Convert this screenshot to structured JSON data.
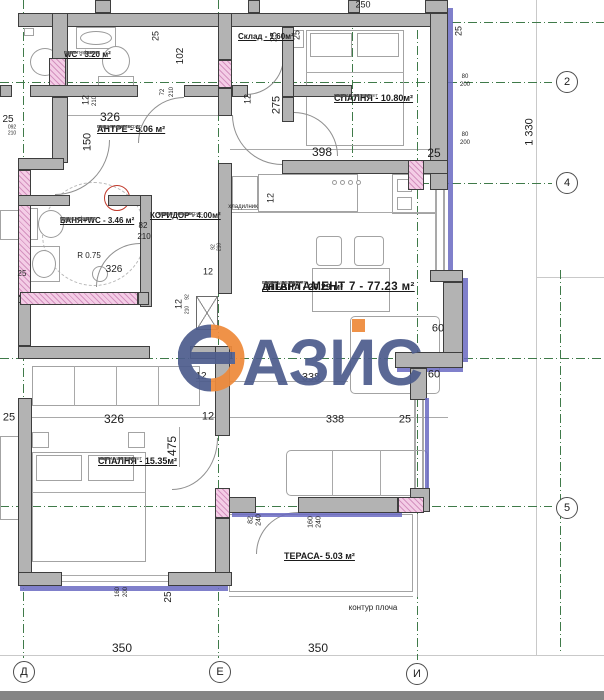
{
  "watermark": {
    "brand": "ОАЗИС",
    "rest": "АЗИС",
    "blue": "#4e5d8d",
    "orange": "#ee8a3b"
  },
  "apartment_title": "АПАРТАМЕНТ 7 - 77.23 м²",
  "rooms": {
    "wc": {
      "name": "WC - 3.20 м²",
      "f1": "под - теракот",
      "f2": "стени - фаянс",
      "f3": "таван - латекс"
    },
    "sklad": {
      "name": "Склад - 1.60м²"
    },
    "antre": {
      "name": "АНТРЕ - 5.06 м²",
      "f1": "под - гранитогрес",
      "f2": "стени - латекс",
      "f3": "таван - латекс"
    },
    "banya": {
      "name": "БАНЯ+WC - 3.46 м²",
      "f1": "под - теракот",
      "f2": "стени - фаянс",
      "f3": "таван - латекс"
    },
    "koridor": {
      "name": "КОРИДОР - 4.00м²",
      "f1": "под - гранитогрес",
      "f2": "стени - латекс",
      "f3": "таван - латекс"
    },
    "spalnya1": {
      "name": "СПАЛНЯ - 10.80м²",
      "f1": "под - лам. паркет",
      "f2": "стени - латекс",
      "f3": "таван - латекс"
    },
    "dnevna": {
      "name": "ДНЕВНА - 20.29 м²",
      "f1": "под - лам. паркет",
      "f2": "стени - латекс",
      "f3": "таван - латекс"
    },
    "spalnya2": {
      "name": "СПАЛНЯ - 15.35м²",
      "f1": "под - лам. паркет",
      "f2": "стени - латекс",
      "f3": "таван - латекс"
    },
    "terasa": {
      "name": "ТЕРАСА- 5.03 м²"
    }
  },
  "grid": {
    "c2": "2",
    "c4": "4",
    "c5": "5",
    "d": "Д",
    "e": "Е",
    "i": "И"
  },
  "labels": [
    {
      "t": "250",
      "x": 363,
      "y": 5,
      "s": 9
    },
    {
      "t": "25",
      "x": 156,
      "y": 36,
      "s": 9,
      "r": 1
    },
    {
      "t": "102",
      "x": 181,
      "y": 56,
      "s": 10,
      "r": 1
    },
    {
      "t": "25",
      "x": 274,
      "y": 37,
      "s": 9,
      "r": 1
    },
    {
      "t": "25",
      "x": 297,
      "y": 35,
      "s": 9,
      "r": 1
    },
    {
      "t": "275",
      "x": 277,
      "y": 105,
      "s": 11,
      "r": 1
    },
    {
      "t": "12",
      "x": 86,
      "y": 100,
      "s": 9,
      "r": 1
    },
    {
      "t": "210",
      "x": 95,
      "y": 101,
      "s": 6,
      "r": 1
    },
    {
      "t": "72",
      "x": 163,
      "y": 92,
      "s": 6,
      "r": 1
    },
    {
      "t": "210",
      "x": 172,
      "y": 92,
      "s": 6,
      "r": 1
    },
    {
      "t": "12",
      "x": 248,
      "y": 99,
      "s": 9,
      "r": 1
    },
    {
      "t": "326",
      "x": 110,
      "y": 117,
      "s": 12
    },
    {
      "t": "092",
      "x": 12,
      "y": 128,
      "s": 5
    },
    {
      "t": "210",
      "x": 12,
      "y": 134,
      "s": 5
    },
    {
      "t": "25",
      "x": 8,
      "y": 120,
      "s": 10
    },
    {
      "t": "150",
      "x": 88,
      "y": 142,
      "s": 11,
      "r": 1
    },
    {
      "t": "398",
      "x": 322,
      "y": 152,
      "s": 12
    },
    {
      "t": "25",
      "x": 434,
      "y": 153,
      "s": 12
    },
    {
      "t": "25",
      "x": 459,
      "y": 31,
      "s": 9,
      "r": 1
    },
    {
      "t": "80",
      "x": 465,
      "y": 77,
      "s": 6
    },
    {
      "t": "200",
      "x": 465,
      "y": 85,
      "s": 6
    },
    {
      "t": "80",
      "x": 465,
      "y": 135,
      "s": 6
    },
    {
      "t": "200",
      "x": 465,
      "y": 143,
      "s": 6
    },
    {
      "t": "12",
      "x": 271,
      "y": 198,
      "s": 9,
      "r": 1
    },
    {
      "t": "хладилник",
      "x": 243,
      "y": 207,
      "s": 6
    },
    {
      "t": "82",
      "x": 143,
      "y": 226,
      "s": 8
    },
    {
      "t": "210",
      "x": 144,
      "y": 237,
      "s": 8
    },
    {
      "t": "25",
      "x": 22,
      "y": 274,
      "s": 8
    },
    {
      "t": "12",
      "x": 208,
      "y": 272,
      "s": 9
    },
    {
      "t": "92",
      "x": 214,
      "y": 247,
      "s": 5,
      "r": 1
    },
    {
      "t": "210",
      "x": 220,
      "y": 247,
      "s": 5,
      "r": 1
    },
    {
      "t": "326",
      "x": 114,
      "y": 270,
      "s": 10
    },
    {
      "t": "R 0.75",
      "x": 89,
      "y": 256,
      "s": 8
    },
    {
      "t": "12",
      "x": 179,
      "y": 304,
      "s": 9,
      "r": 1
    },
    {
      "t": "92",
      "x": 188,
      "y": 297,
      "s": 5,
      "r": 1
    },
    {
      "t": "210",
      "x": 188,
      "y": 310,
      "s": 5,
      "r": 1
    },
    {
      "t": "12",
      "x": 201,
      "y": 377,
      "s": 10
    },
    {
      "t": "338",
      "x": 311,
      "y": 378,
      "s": 11
    },
    {
      "t": "60",
      "x": 438,
      "y": 329,
      "s": 11
    },
    {
      "t": "60",
      "x": 434,
      "y": 375,
      "s": 11
    },
    {
      "t": "326",
      "x": 114,
      "y": 419,
      "s": 12
    },
    {
      "t": "12",
      "x": 208,
      "y": 417,
      "s": 11
    },
    {
      "t": "338",
      "x": 335,
      "y": 420,
      "s": 11
    },
    {
      "t": "25",
      "x": 405,
      "y": 420,
      "s": 11
    },
    {
      "t": "25",
      "x": 9,
      "y": 418,
      "s": 11
    },
    {
      "t": "475",
      "x": 172,
      "y": 446,
      "s": 12,
      "r": 1
    },
    {
      "t": "82",
      "x": 251,
      "y": 520,
      "s": 7,
      "r": 1
    },
    {
      "t": "240",
      "x": 259,
      "y": 520,
      "s": 7,
      "r": 1
    },
    {
      "t": "160",
      "x": 311,
      "y": 522,
      "s": 7,
      "r": 1
    },
    {
      "t": "240",
      "x": 319,
      "y": 522,
      "s": 7,
      "r": 1
    },
    {
      "t": "160",
      "x": 118,
      "y": 592,
      "s": 6,
      "r": 1
    },
    {
      "t": "200",
      "x": 126,
      "y": 592,
      "s": 6,
      "r": 1
    },
    {
      "t": "25",
      "x": 169,
      "y": 597,
      "s": 10,
      "r": 1
    },
    {
      "t": "350",
      "x": 122,
      "y": 648,
      "s": 12
    },
    {
      "t": "350",
      "x": 318,
      "y": 648,
      "s": 12
    },
    {
      "t": "контур плоча",
      "x": 373,
      "y": 608,
      "s": 8
    },
    {
      "t": "1 330",
      "x": 530,
      "y": 132,
      "s": 11,
      "r": 1
    }
  ]
}
